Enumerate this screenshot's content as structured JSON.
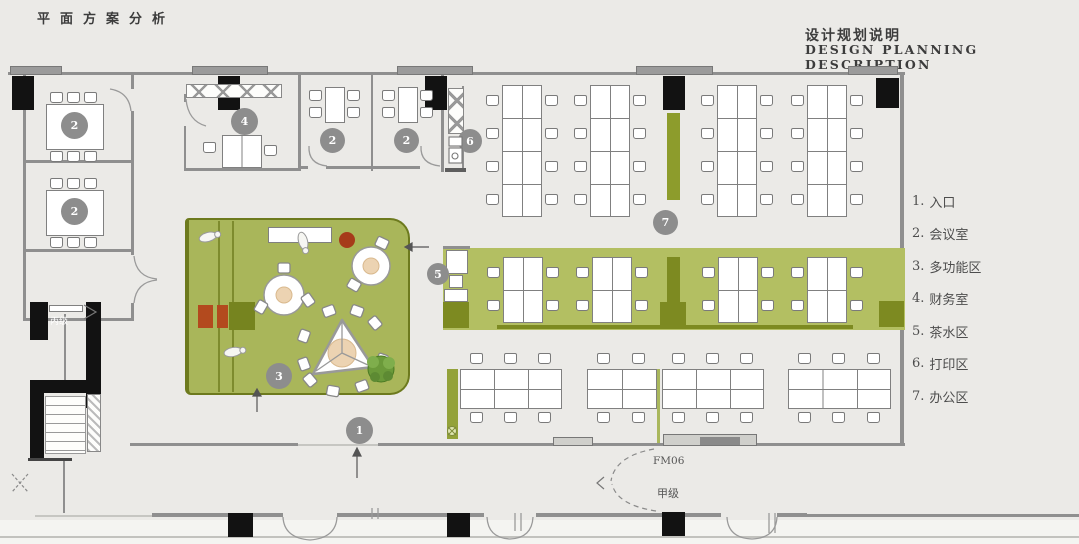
{
  "titles": {
    "plan": "平面方案分析",
    "desc_cn": "设计规划说明",
    "desc_en": "DESIGN PLANNING DESCRIPTION"
  },
  "legend": [
    {
      "num": "1.",
      "label": "入口"
    },
    {
      "num": "2.",
      "label": "会议室"
    },
    {
      "num": "3.",
      "label": "多功能区"
    },
    {
      "num": "4.",
      "label": "财务室"
    },
    {
      "num": "5.",
      "label": "茶水区"
    },
    {
      "num": "6.",
      "label": "打印区"
    },
    {
      "num": "7.",
      "label": "办公区"
    }
  ],
  "markers": {
    "m1": "1",
    "m2": "2",
    "m3": "3",
    "m4": "4",
    "m5": "5",
    "m6": "6",
    "m7": "7"
  },
  "door_labels": {
    "fm06": "FM06",
    "grade_a": "甲级",
    "grade_c": "丙级"
  },
  "colors": {
    "background": "#ebeae7",
    "green_room": "#a9b65a",
    "green_band": "#b3bf62",
    "olive_dark": "#7d8a21",
    "green_bar": "#8d9c2c",
    "accent_red": "#b34a1e",
    "wall_gray": "#8f8f8f",
    "column_black": "#121212",
    "marker_gray": "#8d8d8d"
  }
}
